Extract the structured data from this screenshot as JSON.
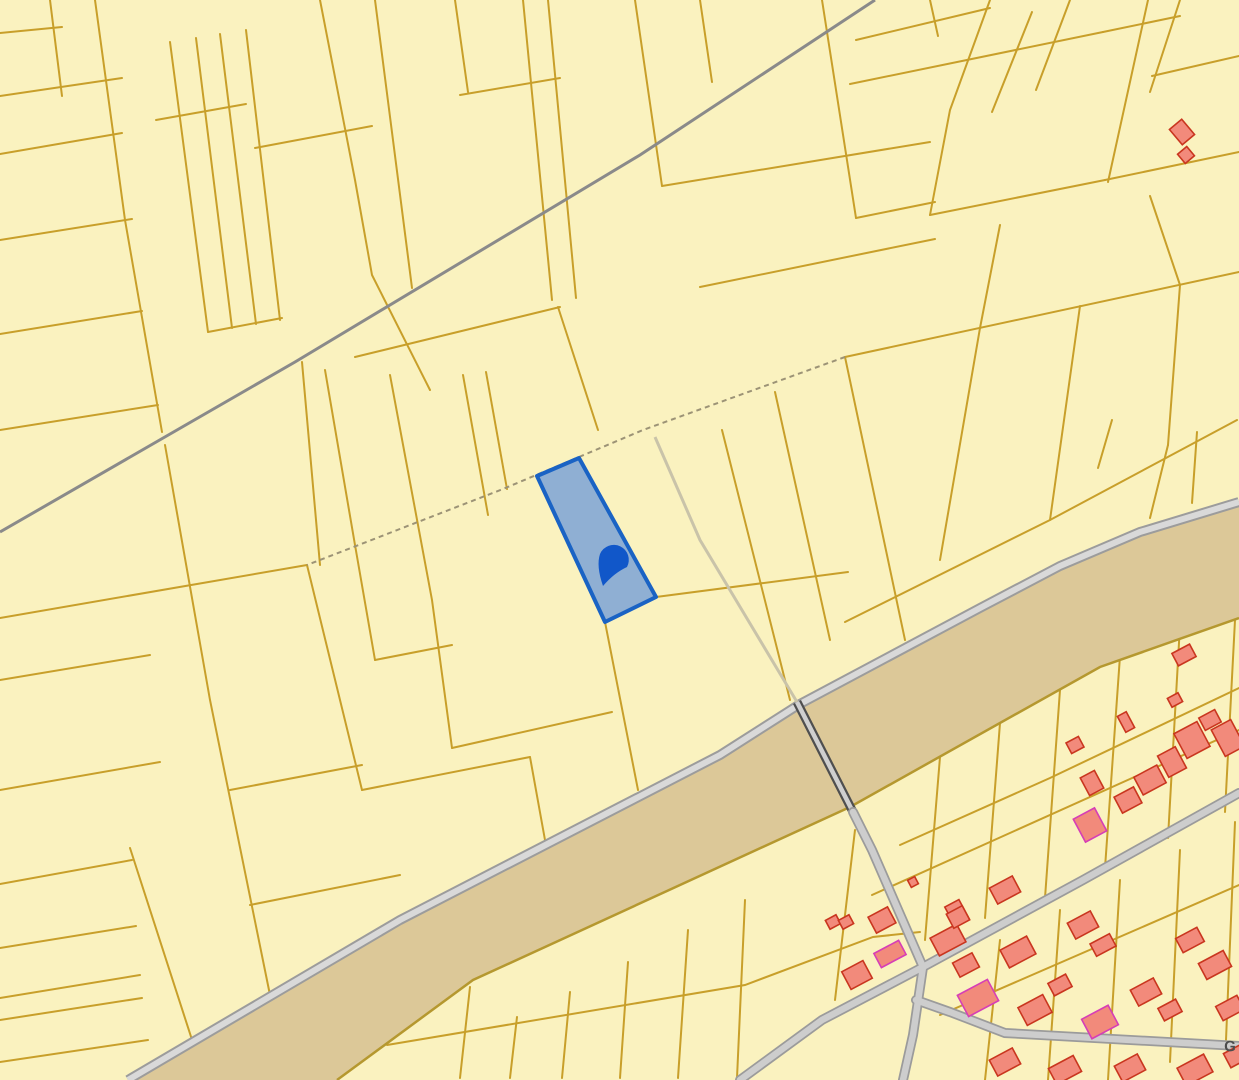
{
  "map": {
    "canvas": {
      "width": 1239,
      "height": 1080
    },
    "colors": {
      "parcel_fill": "#FAF2BF",
      "parcel_line": "#C89F2A",
      "canal_fill": "#DCC898",
      "canal_edge": "#B5982F",
      "canal_stripe_fill": "#D9D9D9",
      "canal_stripe_casing": "#9C9C9C",
      "top_road": "#8A8A8A",
      "minor_road": "#C9C3A9",
      "dashed_boundary": "#9C9376",
      "bridge_casing": "#4F4F4F",
      "bridge_fill": "#CFCFCF",
      "village_road_casing": "#9B9B9B",
      "village_road_fill": "#CDCDCD",
      "building_fill": "#F28A7B",
      "building_stroke": "#C9361F",
      "building_stroke_alt": "#D63EB6",
      "selected_fill": "#8FAFD3",
      "selected_stroke": "#1A63C4",
      "marker_fill": "#1157C9",
      "label_color": "#4D4D4D"
    },
    "selected_parcel": {
      "points": "537,476 579,458 656,597 605,622"
    },
    "marker": {
      "path": "M603,586 Q596,566 600,554 A15,15 0 1 1 627,567 Q614,573 603,586 Z"
    },
    "street_label": {
      "text": "G",
      "transform": "translate(1224,1051) rotate(2)"
    },
    "layers": {
      "canal": {
        "fill_points": "128,1080 400,920 720,755 800,704 980,608 1060,566 1140,532 1239,502 1239,618 1100,667 850,807 473,980 337,1080",
        "top_stripe": "128,1080 400,920 720,755 800,704 980,608 1060,566 1140,532 1239,502",
        "lower_edge": "1239,618 1100,667 850,807 473,980 337,1080"
      },
      "parcel_lines": [
        "0,33 62,27",
        "0,96 122,78",
        "50,0 62,96",
        "95,0 125,220 162,432",
        "0,154 122,133",
        "0,240 132,219",
        "0,334 142,311",
        "0,430 158,405",
        "156,120 246,104",
        "170,42 208,332",
        "196,38 232,328",
        "220,34 256,324",
        "246,30 280,320",
        "208,332 282,318",
        "320,0 355,180 372,275 430,390",
        "255,148 372,126",
        "375,0 412,288",
        "455,0 468,92",
        "460,95 560,78",
        "355,357 560,307",
        "523,0 552,300",
        "548,0 576,298",
        "558,307 598,430",
        "635,0 662,186",
        "700,0 712,82",
        "662,186 930,142",
        "822,0 856,218",
        "930,0 938,36",
        "856,218 935,202",
        "700,287 935,239",
        "990,0 950,110 930,215",
        "1032,12 992,112",
        "1070,0 1036,90",
        "856,40 990,8",
        "850,84 1103,32",
        "930,215 1105,180",
        "1148,0 1108,182",
        "1180,0 1150,92",
        "1239,56 1152,76",
        "1103,32 1180,16",
        "1105,180 1239,152",
        "1150,196 1180,285",
        "1000,225 980,328",
        "845,357 1239,272",
        "845,622 1050,520 1237,420",
        "980,328 940,560",
        "1080,306 1050,520",
        "1180,285 1168,445",
        "1168,445 1150,518",
        "1197,432 1192,503",
        "1112,420 1098,468",
        "845,357 905,640",
        "775,392 830,640",
        "722,430 790,700",
        "656,597 848,572",
        "302,362 320,565",
        "325,370 355,545 375,660",
        "390,375 432,600 452,748",
        "463,375 488,515",
        "486,372 507,489",
        "165,445 210,700 270,995",
        "307,565 362,790",
        "0,618 307,565",
        "0,680 150,655",
        "0,790 160,762",
        "130,848 205,1080",
        "0,884 132,860",
        "0,948 136,926",
        "0,998 140,975",
        "0,1020 142,998",
        "0,1062 148,1040",
        "605,622 638,790",
        "452,748 612,712",
        "375,660 452,645",
        "362,790 530,757",
        "530,757 545,840",
        "230,790 362,765",
        "250,905 400,875",
        "470,987 460,1078",
        "517,1017 510,1078",
        "570,992 562,1078",
        "628,962 620,1078",
        "688,930 678,1078",
        "745,900 737,1078",
        "387,1045 745,985 873,937 920,932",
        "940,757 925,940",
        "1000,723 985,918",
        "1060,690 1045,898",
        "1120,656 1105,868",
        "1180,625 1168,838",
        "1235,620 1225,812",
        "900,845 1050,778 1239,688",
        "872,895 1239,730",
        "1000,940 985,1080",
        "1060,910 1048,1080",
        "1120,880 1108,1080",
        "1180,850 1170,1062",
        "1235,822 1226,1040",
        "940,1015 1239,885",
        "855,830 835,1000"
      ],
      "dashed_lines": [
        "845,357 643,430 503,489 307,565"
      ],
      "gray_roads": [
        "875,0 640,155 295,362 0,532"
      ],
      "minor_roads": [
        "655,437 700,540 797,702"
      ],
      "bridge": "797,702 853,812",
      "village_roads": [
        "740,1080 822,1020 923,967 1083,880 1239,793",
        "853,812 872,850 923,967 913,1035 903,1080",
        "916,1000 950,1012 1005,1033 1239,1046"
      ],
      "buildings": [
        {
          "cx": 957,
          "cy": 913,
          "w": 16,
          "h": 22,
          "a": -28
        },
        {
          "cx": 1005,
          "cy": 890,
          "w": 26,
          "h": 18,
          "a": -28
        },
        {
          "cx": 1018,
          "cy": 952,
          "w": 30,
          "h": 20,
          "a": -28
        },
        {
          "cx": 966,
          "cy": 965,
          "w": 22,
          "h": 16,
          "a": -28
        },
        {
          "cx": 978,
          "cy": 998,
          "w": 34,
          "h": 24,
          "a": -28,
          "alt": true
        },
        {
          "cx": 1035,
          "cy": 1010,
          "w": 28,
          "h": 20,
          "a": -28
        },
        {
          "cx": 1083,
          "cy": 925,
          "w": 26,
          "h": 18,
          "a": -28
        },
        {
          "cx": 1103,
          "cy": 945,
          "w": 22,
          "h": 14,
          "a": -28
        },
        {
          "cx": 1060,
          "cy": 985,
          "w": 20,
          "h": 14,
          "a": -28
        },
        {
          "cx": 1100,
          "cy": 1022,
          "w": 30,
          "h": 22,
          "a": -28,
          "alt": true
        },
        {
          "cx": 1146,
          "cy": 992,
          "w": 26,
          "h": 18,
          "a": -28
        },
        {
          "cx": 1170,
          "cy": 1010,
          "w": 20,
          "h": 14,
          "a": -28
        },
        {
          "cx": 1190,
          "cy": 940,
          "w": 24,
          "h": 16,
          "a": -28
        },
        {
          "cx": 1215,
          "cy": 965,
          "w": 28,
          "h": 18,
          "a": -28
        },
        {
          "cx": 1230,
          "cy": 1008,
          "w": 24,
          "h": 16,
          "a": -28
        },
        {
          "cx": 1005,
          "cy": 1062,
          "w": 26,
          "h": 18,
          "a": -28
        },
        {
          "cx": 1065,
          "cy": 1070,
          "w": 28,
          "h": 18,
          "a": -28
        },
        {
          "cx": 1130,
          "cy": 1068,
          "w": 26,
          "h": 18,
          "a": -28
        },
        {
          "cx": 1195,
          "cy": 1070,
          "w": 30,
          "h": 20,
          "a": -28
        },
        {
          "cx": 1236,
          "cy": 1056,
          "w": 20,
          "h": 16,
          "a": -28
        },
        {
          "cx": 1075,
          "cy": 745,
          "w": 14,
          "h": 12,
          "a": -28
        },
        {
          "cx": 1092,
          "cy": 783,
          "w": 16,
          "h": 20,
          "a": -28
        },
        {
          "cx": 1090,
          "cy": 825,
          "w": 24,
          "h": 26,
          "a": -28,
          "alt": true
        },
        {
          "cx": 1128,
          "cy": 800,
          "w": 22,
          "h": 18,
          "a": -28
        },
        {
          "cx": 1150,
          "cy": 780,
          "w": 26,
          "h": 20,
          "a": -28
        },
        {
          "cx": 1172,
          "cy": 762,
          "w": 20,
          "h": 24,
          "a": -28
        },
        {
          "cx": 1192,
          "cy": 740,
          "w": 26,
          "h": 28,
          "a": -28
        },
        {
          "cx": 1210,
          "cy": 720,
          "w": 18,
          "h": 14,
          "a": -28
        },
        {
          "cx": 1228,
          "cy": 738,
          "w": 22,
          "h": 30,
          "a": -28
        },
        {
          "cx": 1126,
          "cy": 722,
          "w": 10,
          "h": 18,
          "a": -28
        },
        {
          "cx": 1175,
          "cy": 700,
          "w": 12,
          "h": 10,
          "a": -28
        },
        {
          "cx": 1184,
          "cy": 655,
          "w": 20,
          "h": 14,
          "a": -28
        },
        {
          "cx": 882,
          "cy": 920,
          "w": 22,
          "h": 18,
          "a": -28
        },
        {
          "cx": 833,
          "cy": 922,
          "w": 12,
          "h": 10,
          "a": -28
        },
        {
          "cx": 846,
          "cy": 922,
          "w": 12,
          "h": 10,
          "a": -28
        },
        {
          "cx": 890,
          "cy": 954,
          "w": 28,
          "h": 16,
          "a": -28,
          "alt": true
        },
        {
          "cx": 857,
          "cy": 975,
          "w": 24,
          "h": 20,
          "a": -28
        },
        {
          "cx": 948,
          "cy": 940,
          "w": 30,
          "h": 20,
          "a": -28
        },
        {
          "cx": 958,
          "cy": 917,
          "w": 18,
          "h": 16,
          "a": -28
        },
        {
          "cx": 913,
          "cy": 882,
          "w": 8,
          "h": 8,
          "a": -28
        },
        {
          "cx": 1182,
          "cy": 132,
          "w": 16,
          "h": 20,
          "a": -40
        },
        {
          "cx": 1186,
          "cy": 155,
          "w": 12,
          "h": 12,
          "a": -40
        }
      ]
    }
  }
}
